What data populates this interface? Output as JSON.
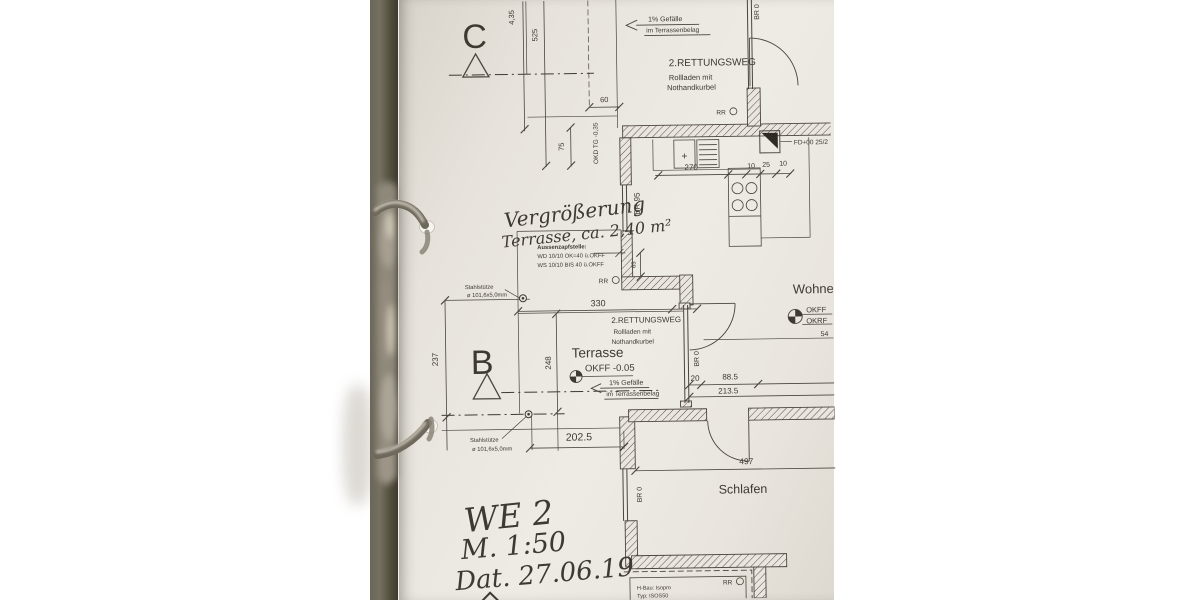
{
  "colors": {
    "paper": "#eae6df",
    "line": "#4a453c",
    "ink": "#3b372f",
    "binder": "#55513f",
    "metal": "#a49d8f"
  },
  "plan": {
    "section_marks": {
      "c": "C",
      "b": "B"
    },
    "rooms": {
      "terrasse": "Terrasse",
      "wohnen": "Wohnen",
      "schlafen": "Schlafen"
    },
    "levels": {
      "okff_terrasse": "OKFF -0.05",
      "okff": "OKFF",
      "okrf": "OKRF",
      "okd": "OKD TG -0,35"
    },
    "notes": {
      "gefaelle_line1": "1% Gefälle",
      "gefaelle_line2": "im Terrassenbelag",
      "rettungsweg_line1": "2.RETTUNGSWEG",
      "rettungsweg_line2": "Rollladen mit",
      "rettungsweg_line3": "Nothandkurbel",
      "aussenzapfstelle_line1": "Aussenzapfstelle:",
      "aussenzapfstelle_line2": "WD 10/10 OK=40 ü.OKFF",
      "aussenzapfstelle_line3": "WS 10/10 BIS 40 ü.OKFF",
      "stahlstuetze_line1": "Stahlstütze",
      "stahlstuetze_line2": "ø 101,6x5,0mm",
      "fd_marker": "FD+00 25/2",
      "hbau_line1": "H-Bau: Isopro",
      "hbau_line2": "Typ: ISOS50",
      "rr": "RR",
      "br0": "BR 0",
      "br95": "BR 95"
    },
    "dimensions": {
      "d_435": "4,35",
      "d_525": "525",
      "d_75": "75",
      "d_60": "60",
      "d_270": "270",
      "d_10a": "10",
      "d_25": "25",
      "d_10b": "10",
      "d_330": "330",
      "d_248": "248",
      "d_237": "237",
      "d_65": "65",
      "d_20": "20",
      "d_885": "88.5",
      "d_2135": "213.5",
      "d_2025": "202.5",
      "d_497": "497",
      "d_54": "54"
    },
    "handwriting": {
      "note_line1": "Vergrößerung",
      "note_line2": "Terrasse, ca. 2,40 m²",
      "unit": "WE 2",
      "scale": "M. 1:50",
      "date": "Dat. 27.06.19"
    }
  }
}
